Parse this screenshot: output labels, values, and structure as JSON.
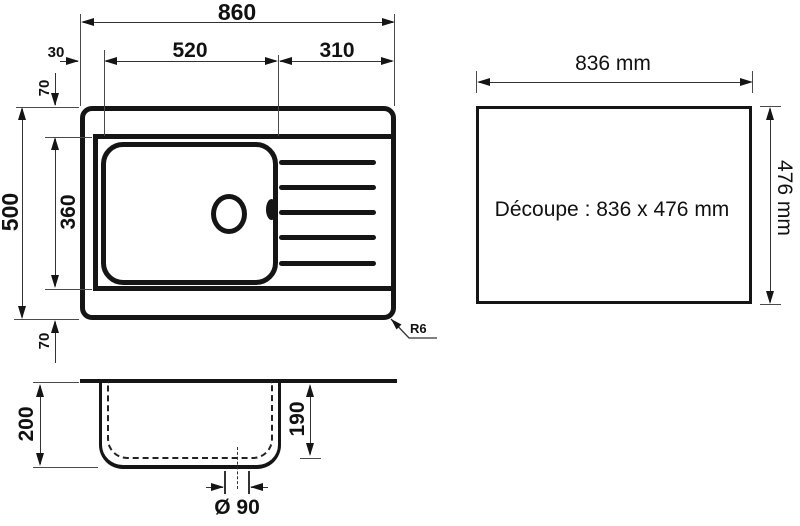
{
  "top_view": {
    "total_width": "860",
    "left_offset": "30",
    "bowl_width": "520",
    "drainer_width": "310",
    "top_offset": "70",
    "total_depth": "500",
    "bowl_depth": "360",
    "bottom_offset": "70",
    "corner_radius": "R6"
  },
  "side_view": {
    "total_height": "200",
    "bowl_inner_depth": "190",
    "drain_diameter": "Ø 90"
  },
  "cutout": {
    "width": "836 mm",
    "height": "476 mm",
    "label": "Découpe : 836 x 476 mm"
  },
  "colors": {
    "line": "#151515",
    "background": "#ffffff"
  }
}
